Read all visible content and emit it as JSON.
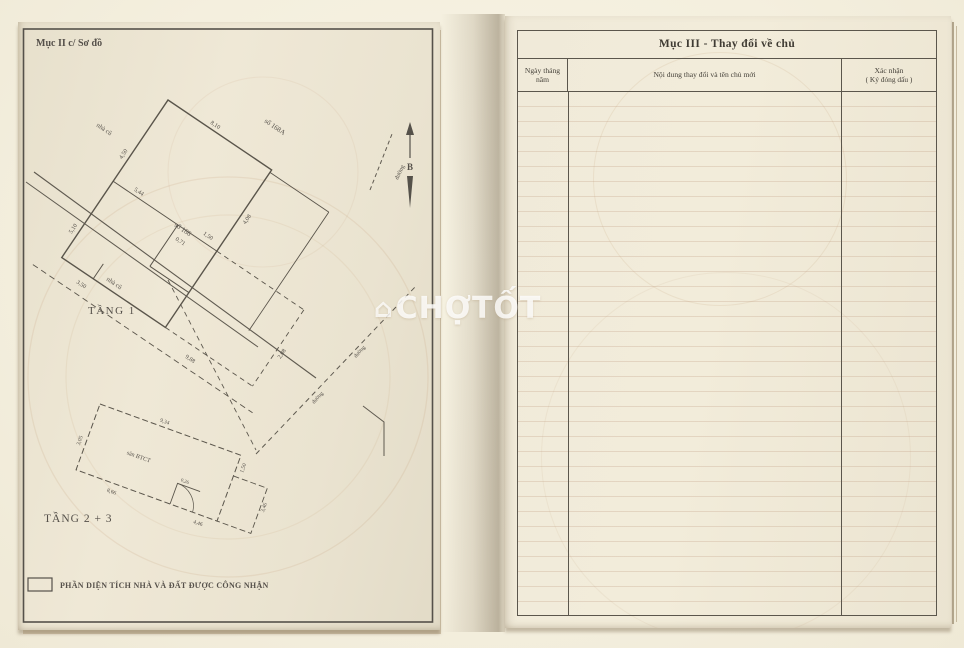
{
  "watermark": {
    "text": "CHỢTỐT",
    "house_icon": "⌂"
  },
  "left_page": {
    "header": "Mục II c/ Sơ đồ",
    "floor1": {
      "label": "TẦNG 1",
      "north": "B",
      "road_label": "đường",
      "neighbors": {
        "top": "số 168A",
        "mid": "số 166",
        "left": "nhà cũ",
        "bottom": "nhà cũ"
      },
      "dims": [
        "8,10",
        "4,50",
        "5,44",
        "0,71",
        "1,50",
        "4,08",
        "9,88",
        "3,50",
        "2,08",
        "5,10"
      ]
    },
    "floor23": {
      "label": "TẦNG 2 + 3",
      "area_label": "sàn BTCT",
      "dims": [
        "3,05",
        "9,34",
        "1,50",
        "8,66",
        "4,46",
        "3,46",
        "0,26"
      ]
    },
    "legend": "PHẦN DIỆN TÍCH NHÀ VÀ ĐẤT ĐƯỢC CÔNG NHẬN"
  },
  "right_page": {
    "title": "Mục III - Thay đổi về chủ",
    "columns": {
      "date": "Ngày tháng năm",
      "content": "Nội dung thay đổi và tên chủ mới",
      "confirm_line1": "Xác nhận",
      "confirm_line2": "( Ký đóng dấu )"
    }
  },
  "colors": {
    "paper": "#ece5d2",
    "line": "#57524a",
    "ink": "#45413a",
    "ruled": "#ba9378"
  }
}
